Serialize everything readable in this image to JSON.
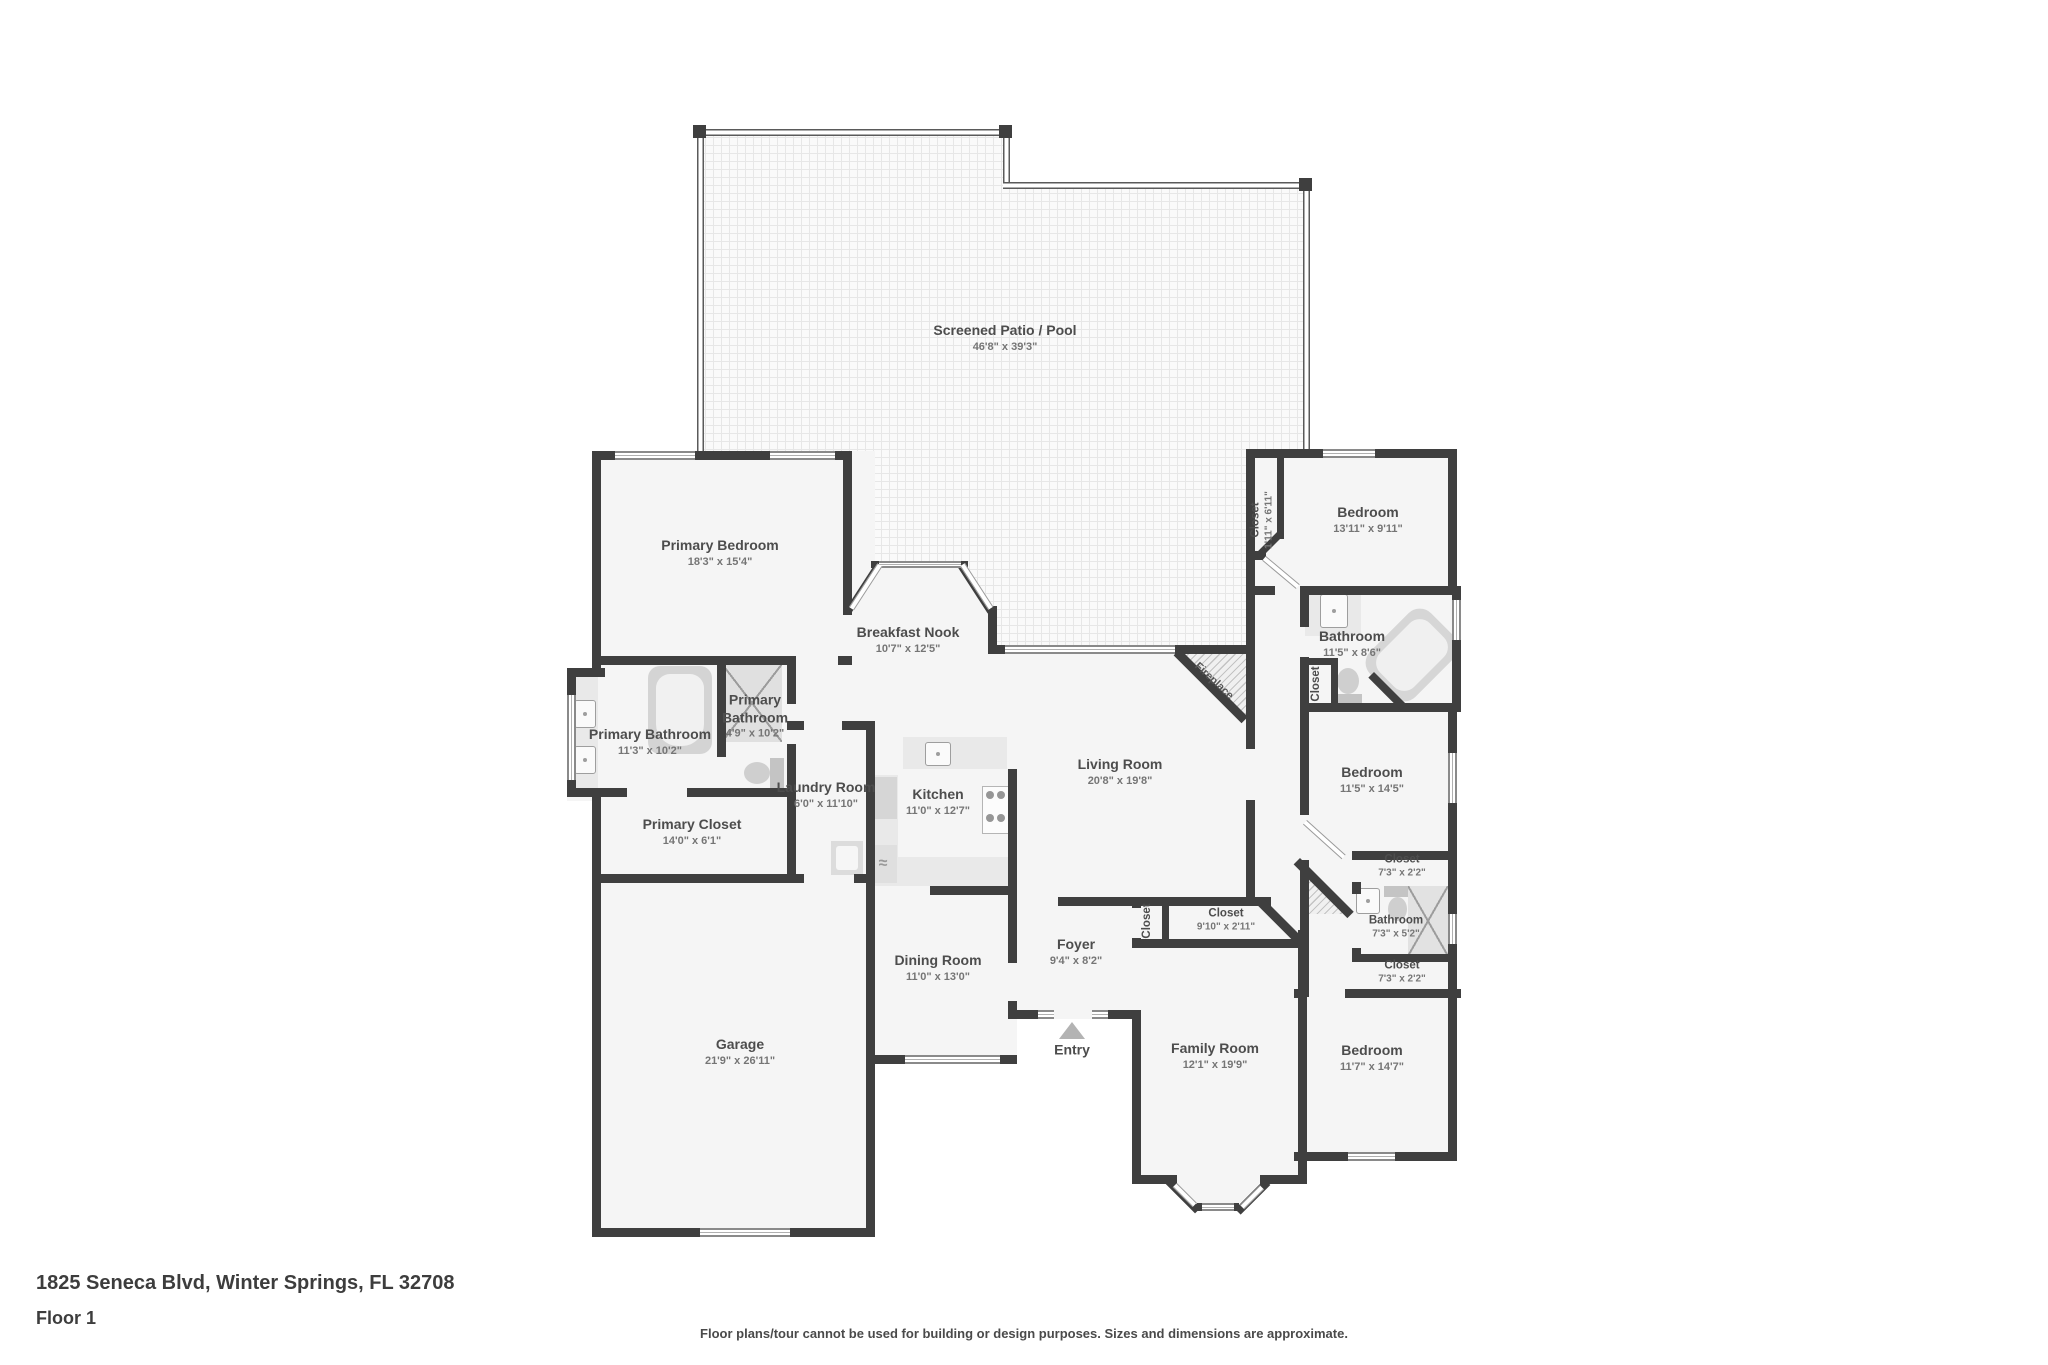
{
  "footer": {
    "address": "1825 Seneca Blvd, Winter Springs, FL 32708",
    "floor": "Floor 1",
    "disclaimer": "Floor plans/tour cannot be used for building or design purposes. Sizes and dimensions are approximate."
  },
  "entry": {
    "label": "Entry"
  },
  "fireplace": {
    "label": "Fireplace"
  },
  "rooms": {
    "patio": {
      "name": "Screened Patio / Pool",
      "dims": "46'8\" x 39'3\""
    },
    "primary_bedroom": {
      "name": "Primary Bedroom",
      "dims": "18'3\" x 15'4\""
    },
    "breakfast_nook": {
      "name": "Breakfast Nook",
      "dims": "10'7\" x 12'5\""
    },
    "primary_bathroom": {
      "name": "Primary Bathroom",
      "dims": "11'3\" x 10'2\""
    },
    "primary_bathroom2": {
      "name": "Primary Bathroom",
      "dims": "4'9\" x 10'2\""
    },
    "primary_closet": {
      "name": "Primary Closet",
      "dims": "14'0\" x 6'1\""
    },
    "laundry": {
      "name": "Laundry Room",
      "dims": "6'0\" x 11'10\""
    },
    "kitchen": {
      "name": "Kitchen",
      "dims": "11'0\" x 12'7\""
    },
    "living": {
      "name": "Living Room",
      "dims": "20'8\" x 19'8\""
    },
    "dining": {
      "name": "Dining Room",
      "dims": "11'0\" x 13'0\""
    },
    "foyer": {
      "name": "Foyer",
      "dims": "9'4\" x 8'2\""
    },
    "garage": {
      "name": "Garage",
      "dims": "21'9\" x 26'11\""
    },
    "family": {
      "name": "Family Room",
      "dims": "12'1\" x 19'9\""
    },
    "bedroom_ne": {
      "name": "Bedroom",
      "dims": "13'11\" x 9'11\""
    },
    "closet_ne": {
      "name": "Closet",
      "dims": "1'11\" x 6'11\""
    },
    "bathroom_e": {
      "name": "Bathroom",
      "dims": "11'5\" x 8'6\""
    },
    "closet_bath": {
      "name": "Closet",
      "dims": ""
    },
    "bedroom_e": {
      "name": "Bedroom",
      "dims": "11'5\" x 14'5\""
    },
    "closet_a": {
      "name": "Closet",
      "dims": "7'3\" x 2'2\""
    },
    "bathroom_se": {
      "name": "Bathroom",
      "dims": "7'3\" x 5'2\""
    },
    "closet_b": {
      "name": "Closet",
      "dims": "7'3\" x 2'2\""
    },
    "bedroom_se": {
      "name": "Bedroom",
      "dims": "11'7\" x 14'7\""
    },
    "closet_hall": {
      "name": "Closet",
      "dims": "9'10\" x 2'11\""
    },
    "closet_foyer": {
      "name": "Closet",
      "dims": ""
    }
  }
}
